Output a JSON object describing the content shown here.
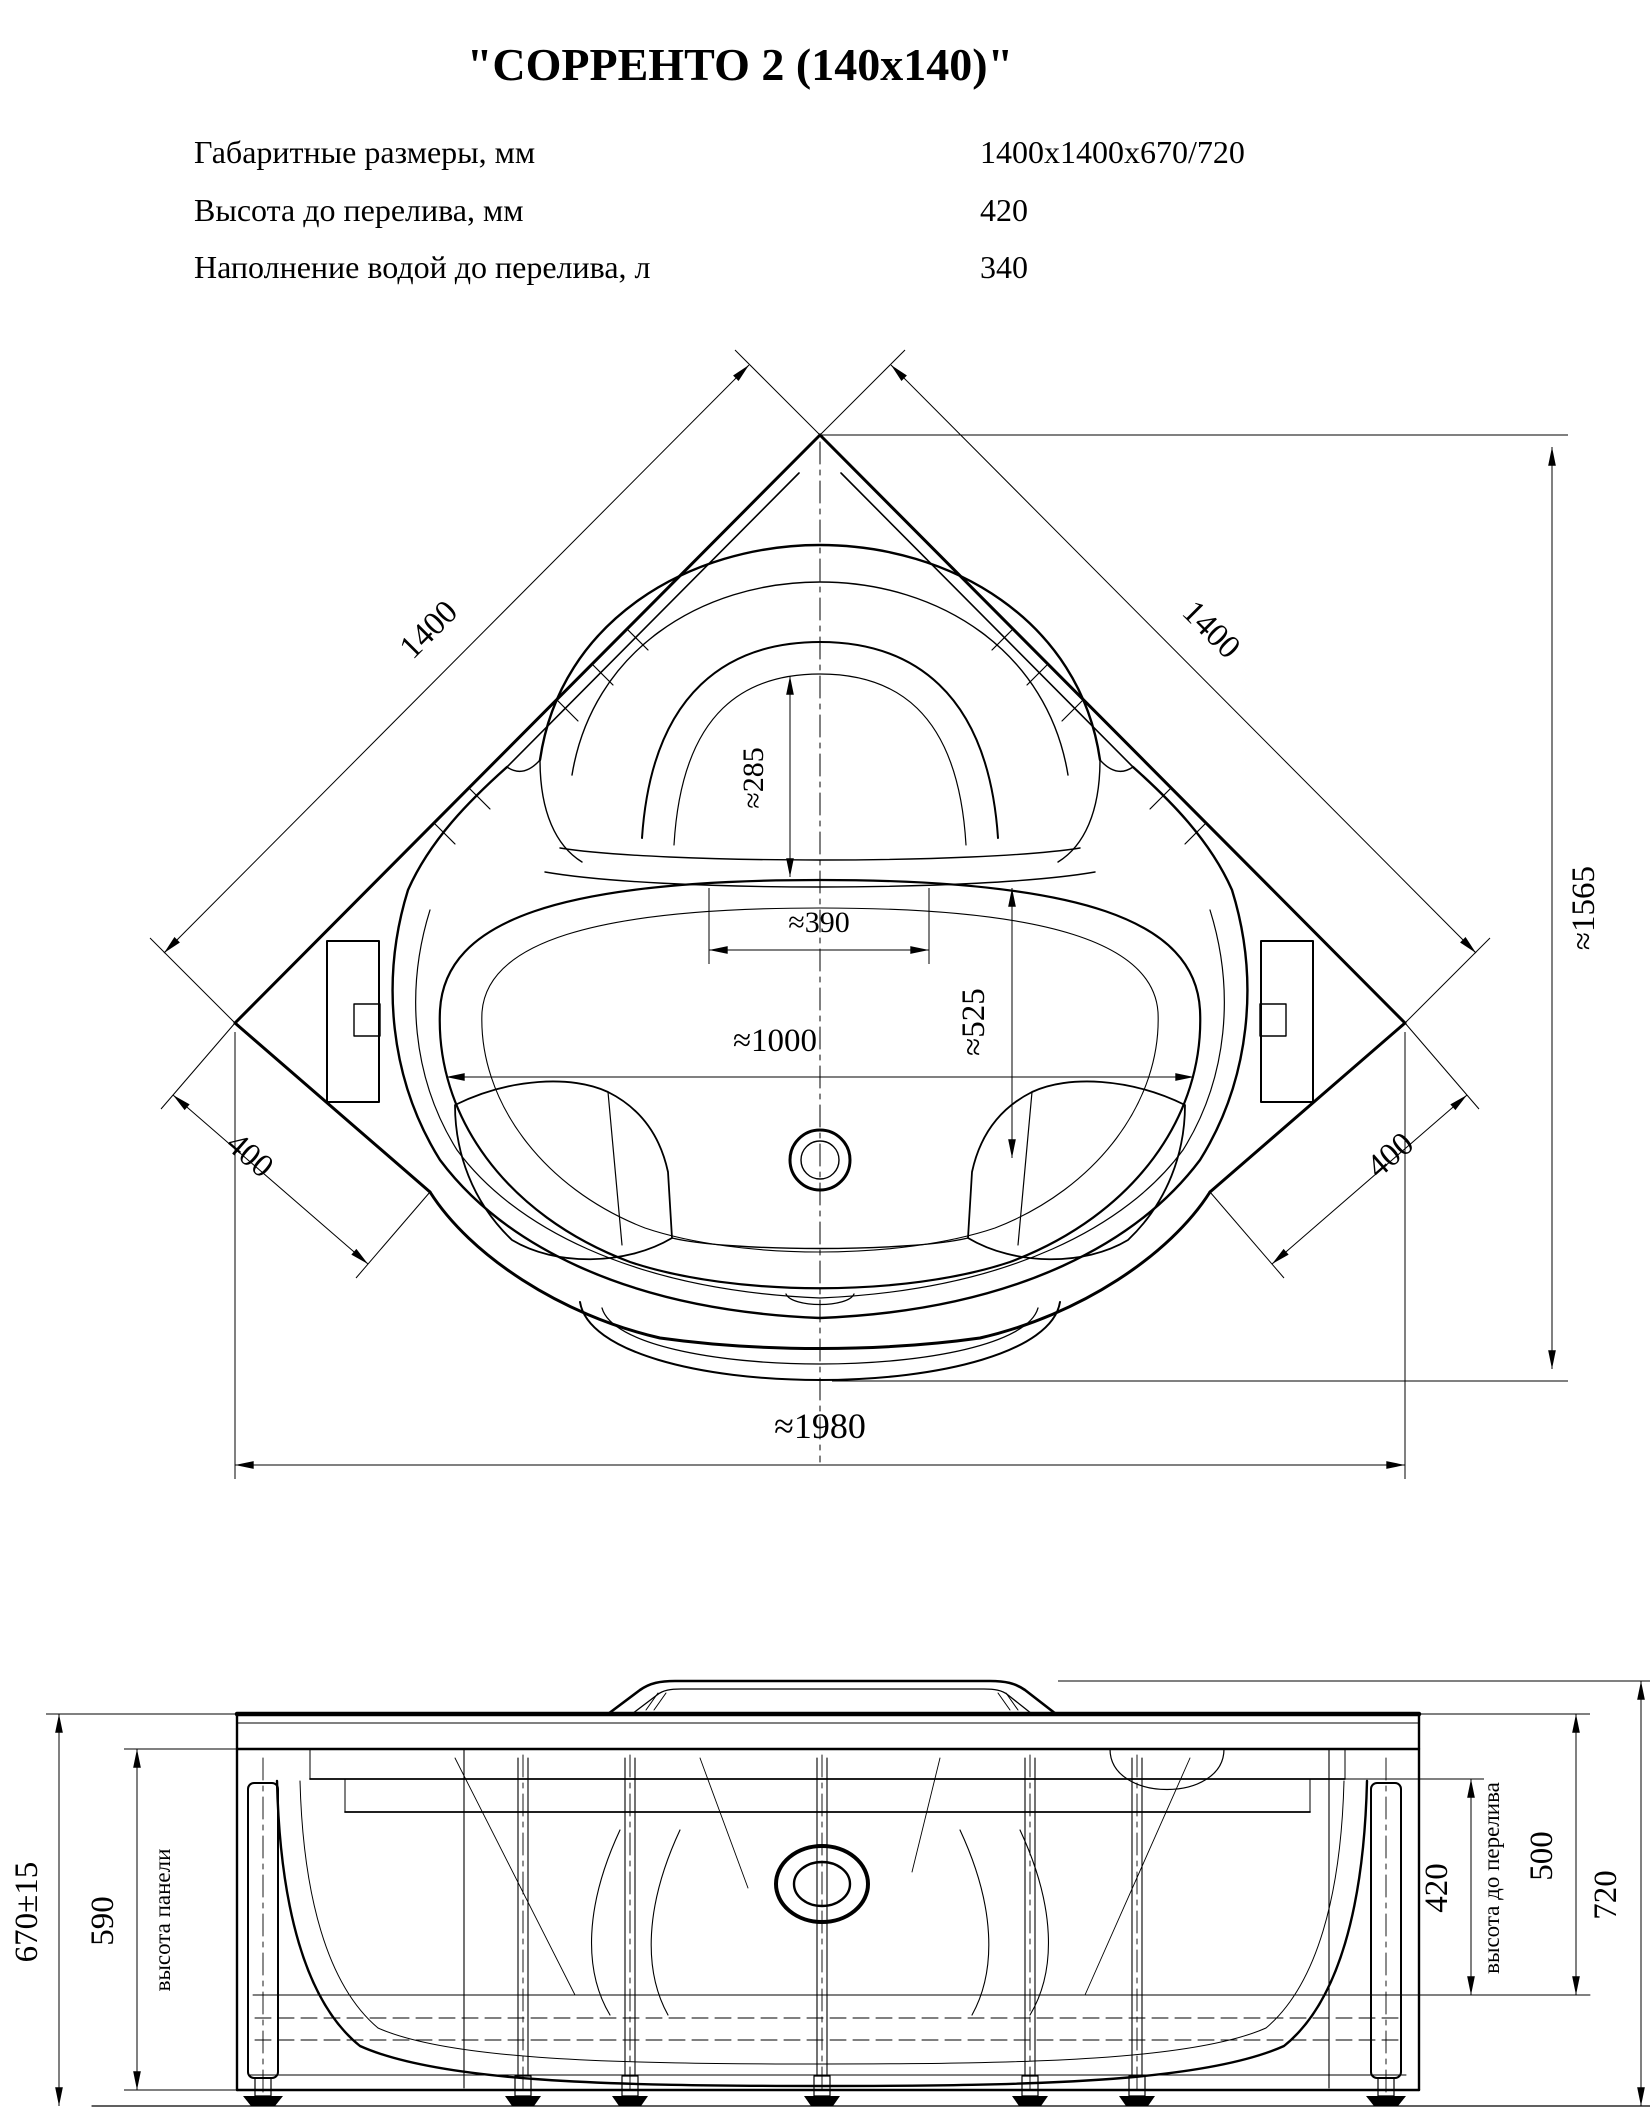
{
  "title": "\"СОРРЕНТО 2 (140x140)\"",
  "specs": {
    "rows": [
      {
        "label": "Габаритные размеры, мм",
        "value": "1400x1400x670/720"
      },
      {
        "label": "Высота до перелива, мм",
        "value": "420"
      },
      {
        "label": "Наполнение водой до перелива, л",
        "value": "340"
      }
    ]
  },
  "top_view": {
    "dim_wall_left": "1400",
    "dim_wall_right": "1400",
    "dim_headrest_depth": "≈285",
    "dim_headrest_width": "≈390",
    "dim_basin_length": "≈1000",
    "dim_basin_width": "≈525",
    "dim_corner_left": "400",
    "dim_corner_right": "400",
    "dim_total_depth": "≈1565",
    "dim_front_width": "≈1980"
  },
  "front_view": {
    "dim_height_overall": "670±15",
    "dim_panel_height": "590",
    "label_panel_height": "высота панели",
    "dim_overflow_height": "420",
    "label_overflow_height": "высота до перелива",
    "dim_inner_height": "500",
    "dim_max_height": "720"
  },
  "colors": {
    "line": "#000000",
    "background": "#ffffff"
  }
}
